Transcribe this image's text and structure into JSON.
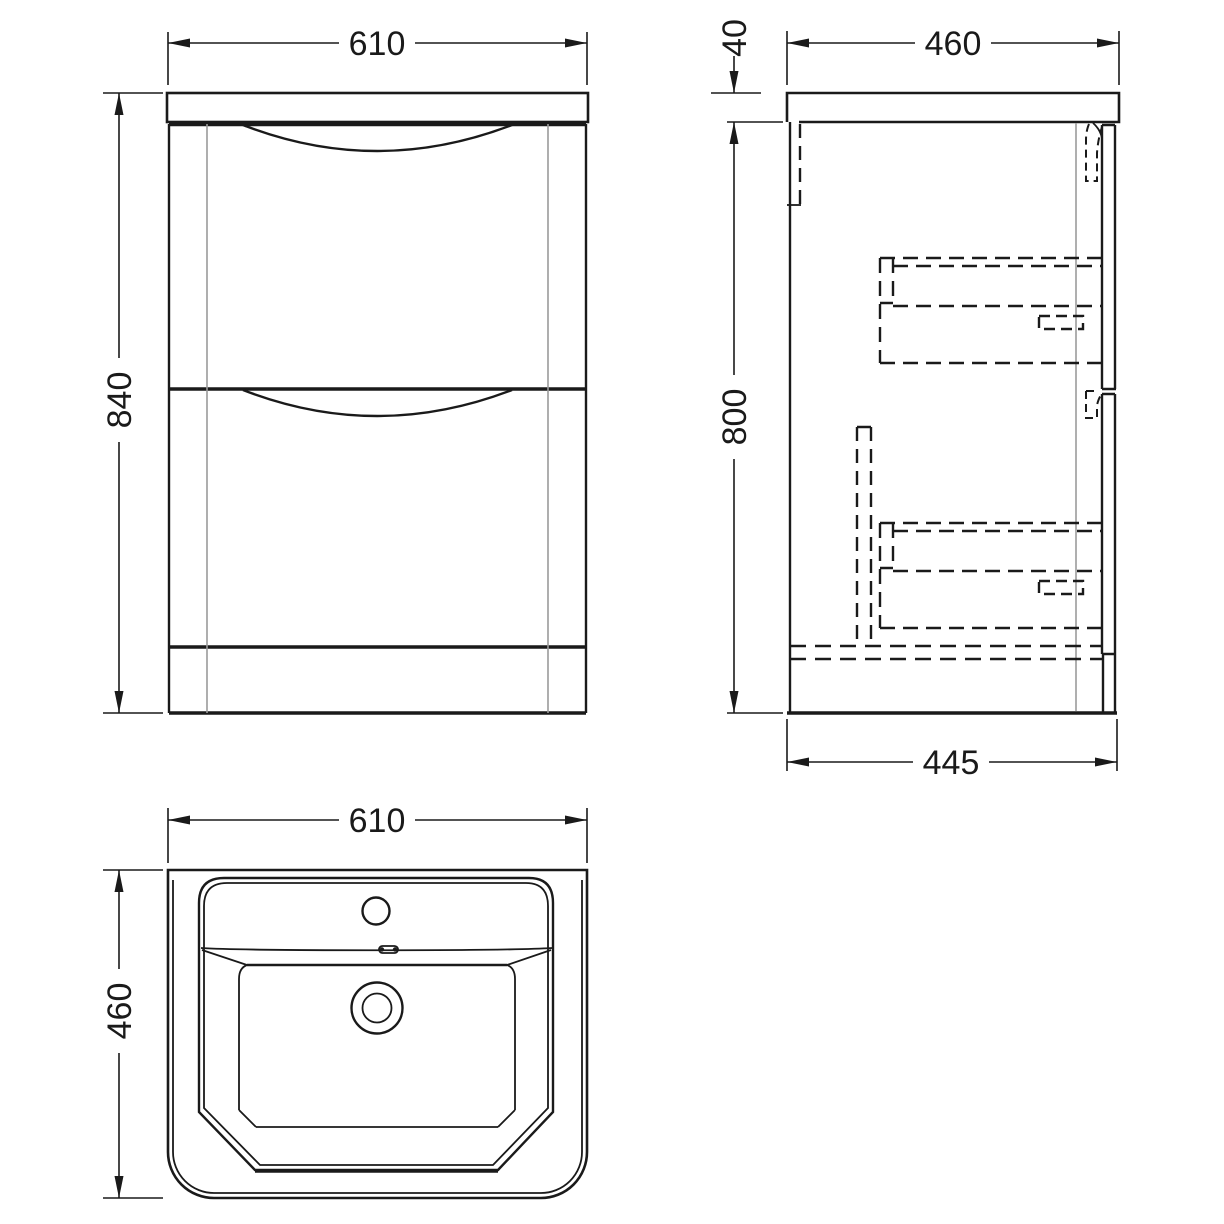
{
  "drawing_type": "furniture technical dimension drawing (vanity unit with basin)",
  "colors": {
    "line": "#1a1a1a",
    "construction_line": "#9b9b9b",
    "background": "#ffffff"
  },
  "views": {
    "front": {
      "width_label": "610",
      "height_label": "840"
    },
    "side": {
      "top_depth_label": "460",
      "counter_thickness_label": "40",
      "height_label": "800",
      "bottom_depth_label": "445"
    },
    "plan": {
      "width_label": "610",
      "depth_label": "460"
    }
  }
}
